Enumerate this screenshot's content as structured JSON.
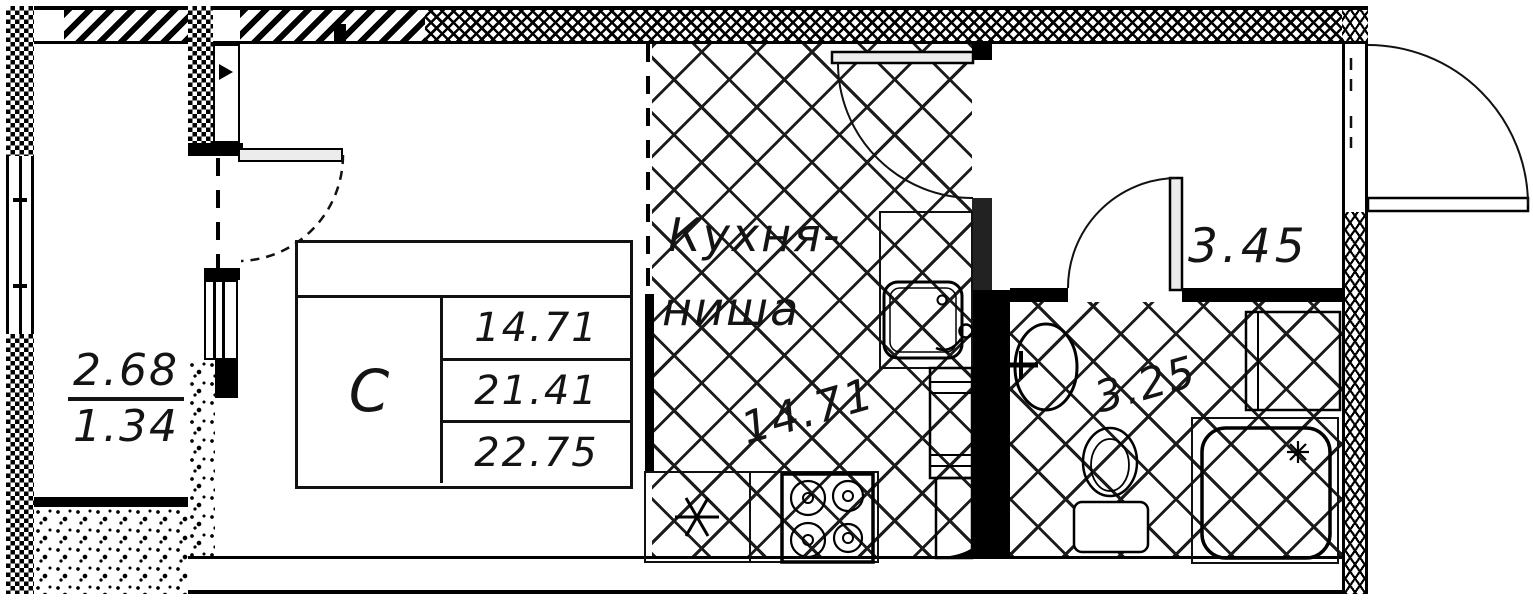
{
  "colors": {
    "line": "#000000",
    "background": "#ffffff",
    "door_leaf": "#ececec",
    "floor_hatch": "#1c1c1c"
  },
  "balcony": {
    "area_top": "2.68",
    "area_bottom": "1.34"
  },
  "stamp": {
    "unit_type": "С",
    "values": [
      "14.71",
      "21.41",
      "22.75"
    ]
  },
  "kitchen": {
    "name_line1": "Кухня-",
    "name_line2": "ниша",
    "area": "14.71"
  },
  "hallway": {
    "area": "3.45"
  },
  "bathroom": {
    "area": "3.25"
  }
}
